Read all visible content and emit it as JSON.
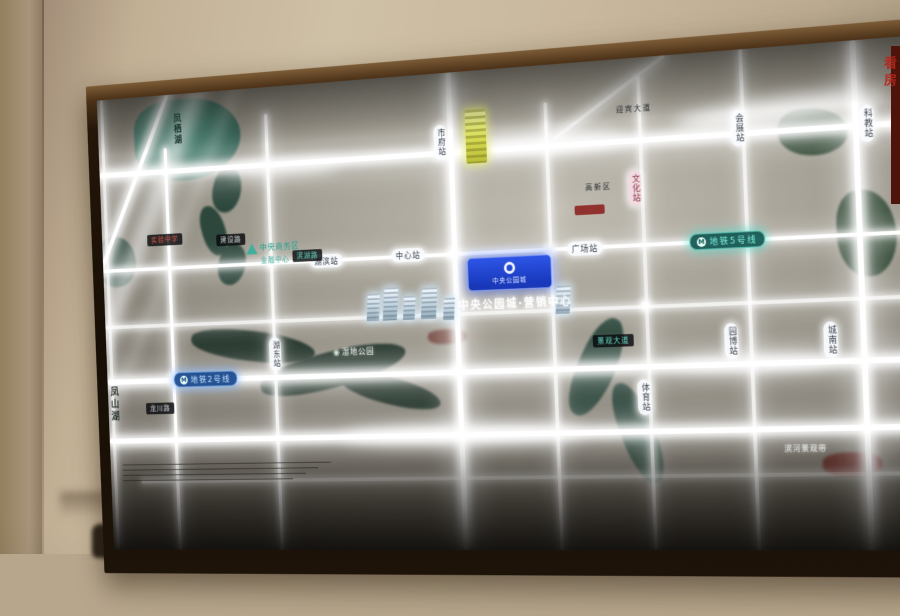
{
  "photo": {
    "watermark": "看房"
  },
  "map": {
    "lake": {
      "name": "凤栖湖"
    },
    "west_lake": {
      "name": "凤山湖"
    },
    "metro5": {
      "badge": "M",
      "label": "地铁5号线"
    },
    "metro2": {
      "badge": "M",
      "label": "地铁2号线"
    },
    "project": {
      "badge_name": "中央公园城",
      "glow_name": "中央公园城·营销中心"
    },
    "stations_v": [
      {
        "name": "市府站"
      },
      {
        "name": "文化站"
      },
      {
        "name": "会展站"
      },
      {
        "name": "科教站"
      },
      {
        "name": "湖东站"
      },
      {
        "name": "体育站"
      },
      {
        "name": "园博站"
      },
      {
        "name": "城南站"
      }
    ],
    "stations_h": [
      {
        "name": "湖滨站"
      },
      {
        "name": "中心站"
      },
      {
        "name": "广场站"
      }
    ],
    "road_pills": [
      {
        "name": "实验中学"
      },
      {
        "name": "建设路"
      },
      {
        "name": "滨湖路"
      },
      {
        "name": "龙川路"
      },
      {
        "name": "景观大道"
      }
    ],
    "areas": {
      "cbd1": "中央商务区",
      "cbd2": "金融中心",
      "wetland": "湿地公园",
      "hitech": "高新区",
      "avenue": "迎宾大道",
      "riverside": "滨河景观带"
    },
    "colors": {
      "metro5_teal": "#2aa79a",
      "metro2_blue": "#2f6fc8",
      "badge_blue": "#1c42cc",
      "water_dark": "#244136",
      "lake_teal": "#3f7468",
      "road_glow": "#ffffff",
      "highlight_yellow": "#d8dc55",
      "accent_red": "#b03226"
    }
  }
}
